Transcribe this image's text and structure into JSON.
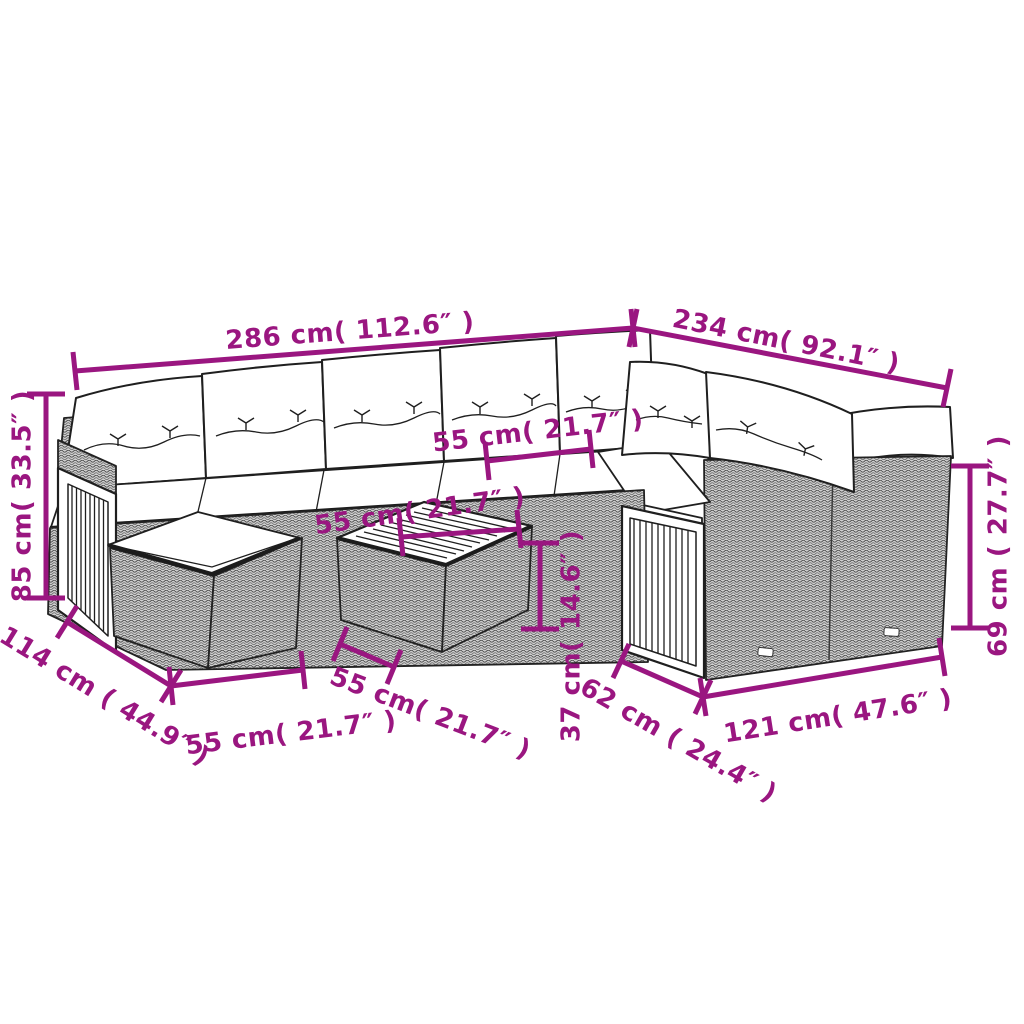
{
  "diagram": {
    "type": "furniture-dimension-diagram",
    "subject": "outdoor poly-rattan lounge set with wood-slat accents, ottoman and coffee table",
    "colors": {
      "dimension_annotation": "#9A1680",
      "line_art": "#1f1f1f",
      "background": "#ffffff",
      "rattan_fill": "#cfcfcf"
    },
    "dimensions": [
      {
        "id": "sofa-left-width",
        "label": "286 cm( 112.6″ )",
        "cm": 286,
        "inches": 112.6
      },
      {
        "id": "sofa-right-width",
        "label": "234 cm( 92.1″ )",
        "cm": 234,
        "inches": 92.1
      },
      {
        "id": "back-height",
        "label": "85 cm( 33.5″ )",
        "cm": 85,
        "inches": 33.5
      },
      {
        "id": "seat-width",
        "label": "55 cm( 21.7″ )",
        "cm": 55,
        "inches": 21.7
      },
      {
        "id": "table-width",
        "label": "55 cm( 21.7″ )",
        "cm": 55,
        "inches": 21.7
      },
      {
        "id": "side-depth",
        "label": "114 cm ( 44.9″ )",
        "cm": 114,
        "inches": 44.9
      },
      {
        "id": "ottoman-width",
        "label": "55 cm( 21.7″ )",
        "cm": 55,
        "inches": 21.7
      },
      {
        "id": "table-depth",
        "label": "55 cm( 21.7″ )",
        "cm": 55,
        "inches": 21.7
      },
      {
        "id": "table-height",
        "label": "37 cm( 14.6″ )",
        "cm": 37,
        "inches": 14.6
      },
      {
        "id": "end-unit-depth",
        "label": "62 cm ( 24.4″ )",
        "cm": 62,
        "inches": 24.4
      },
      {
        "id": "end-unit-width",
        "label": "121 cm( 47.6″ )",
        "cm": 121,
        "inches": 47.6
      },
      {
        "id": "arm-height",
        "label": "69 cm ( 27.7″ )",
        "cm": 69,
        "inches": 27.7
      }
    ]
  }
}
